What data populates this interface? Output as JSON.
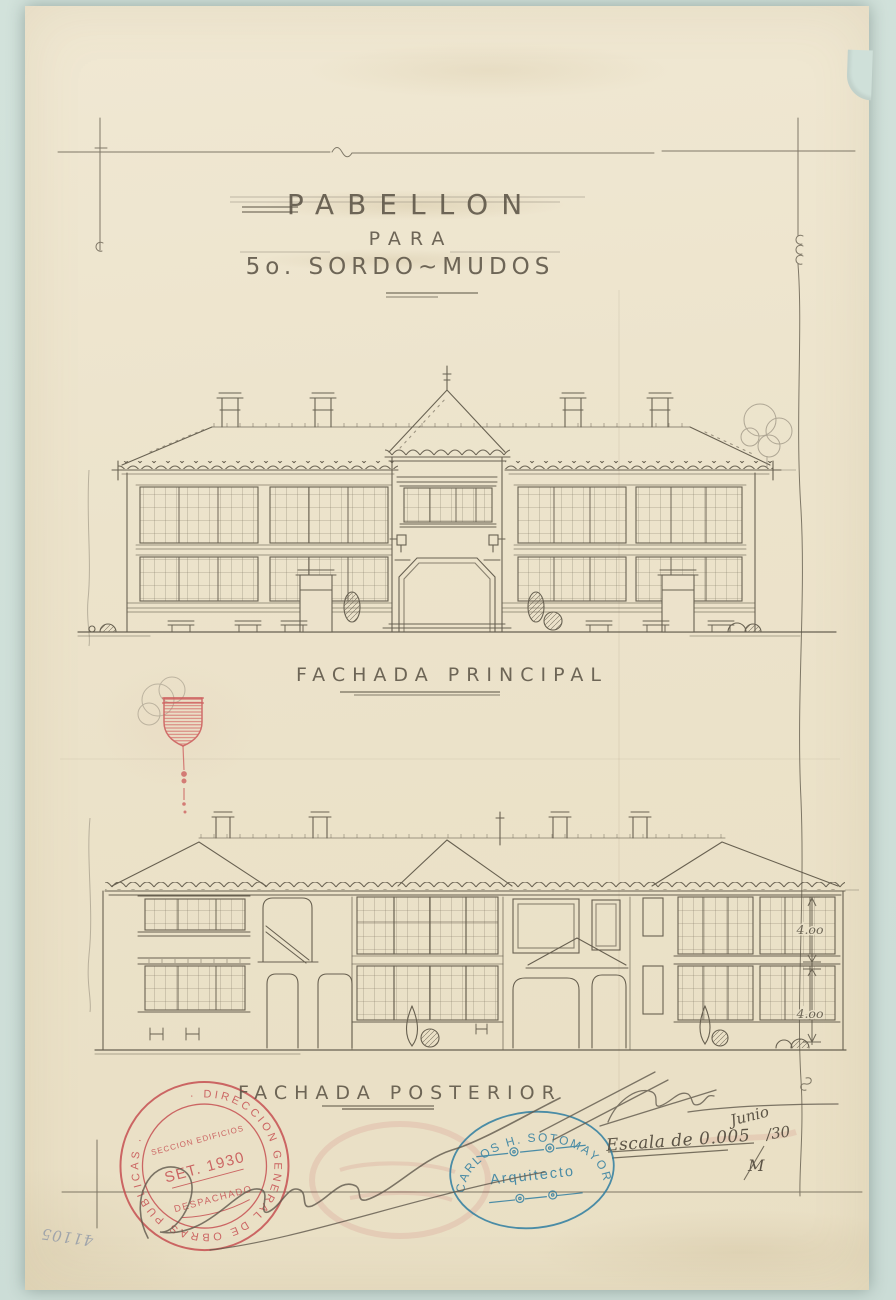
{
  "sheet": {
    "title_line1": "PABELLON",
    "title_line2": "PARA",
    "title_line3": "5o. SORDO~MUDOS",
    "label_main_facade": "FACHADA PRINCIPAL",
    "label_rear_facade": "FACHADA POSTERIOR",
    "scale_note": "Escala de 0.005",
    "date_month": "Junio",
    "date_year": "/30",
    "sheet_mark": "M",
    "archive_number": "41105",
    "dim_upper": "4.oo",
    "dim_lower": "4.oo"
  },
  "stamps": {
    "red_round": {
      "ring_text": "· DIRECCION GENERAL DE OBRAS PUBLICAS ·",
      "line1": "SECCION EDIFICIOS",
      "line2": "SET. 1930",
      "line3": "DESPACHADO",
      "color": "#c4474b"
    },
    "blue_oval": {
      "arc_text": "CARLOS H. SOTOMAYOR L.",
      "center_text": "Arquitecto",
      "color": "#2e7da0"
    }
  },
  "colors": {
    "paper": "#ece3cb",
    "mat": "#cfe0d9",
    "ink": "#5a5344",
    "pencil": "#8e8677",
    "red_ink": "#c4474b",
    "blue_ink": "#2e7da0"
  }
}
